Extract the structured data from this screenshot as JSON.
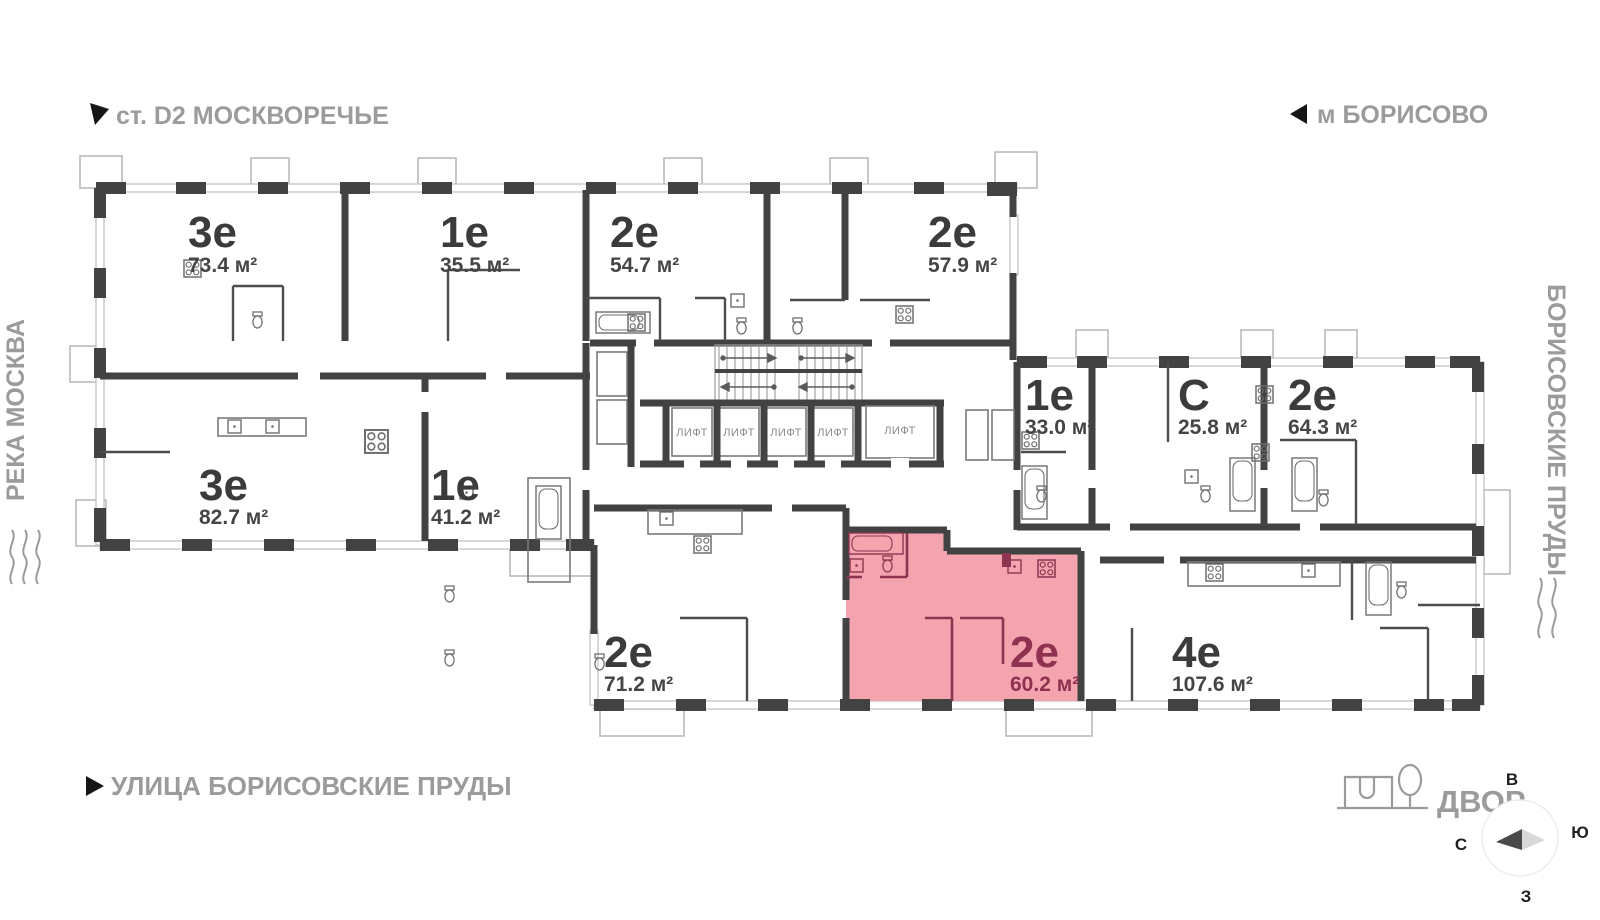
{
  "labels": {
    "station": "ст. D2 МОСКВОРЕЧЬЕ",
    "metro": "м БОРИСОВО",
    "river": "РЕКА МОСКВА",
    "ponds": "БОРИСОВСКИЕ ПРУДЫ",
    "street": "УЛИЦА БОРИСОВСКИЕ ПРУДЫ",
    "courtyard": "ДВОР",
    "elevator": "ЛИФТ"
  },
  "compass": {
    "top": "В",
    "right": "Ю",
    "left": "С",
    "bottom": "З"
  },
  "apartments": [
    {
      "type": "3е",
      "area": "73.4 м²",
      "highlighted": false
    },
    {
      "type": "1е",
      "area": "35.5 м²",
      "highlighted": false
    },
    {
      "type": "2е",
      "area": "54.7 м²",
      "highlighted": false
    },
    {
      "type": "2е",
      "area": "57.9 м²",
      "highlighted": false
    },
    {
      "type": "1е",
      "area": "33.0 м²",
      "highlighted": false
    },
    {
      "type": "С",
      "area": "25.8 м²",
      "highlighted": false
    },
    {
      "type": "2е",
      "area": "64.3 м²",
      "highlighted": false
    },
    {
      "type": "3е",
      "area": "82.7 м²",
      "highlighted": false
    },
    {
      "type": "1е",
      "area": "41.2 м²",
      "highlighted": false
    },
    {
      "type": "2е",
      "area": "71.2 м²",
      "highlighted": false
    },
    {
      "type": "2е",
      "area": "60.2 м²",
      "highlighted": true
    },
    {
      "type": "4е",
      "area": "107.6 м²",
      "highlighted": false
    }
  ],
  "colors": {
    "wall": "#424242",
    "highlight_fill": "#f3a4af",
    "highlight_line": "#8d3550",
    "highlight_text": "#8f3150",
    "label_text": "#3b3b3b",
    "muted_text": "#9b9b9b"
  }
}
